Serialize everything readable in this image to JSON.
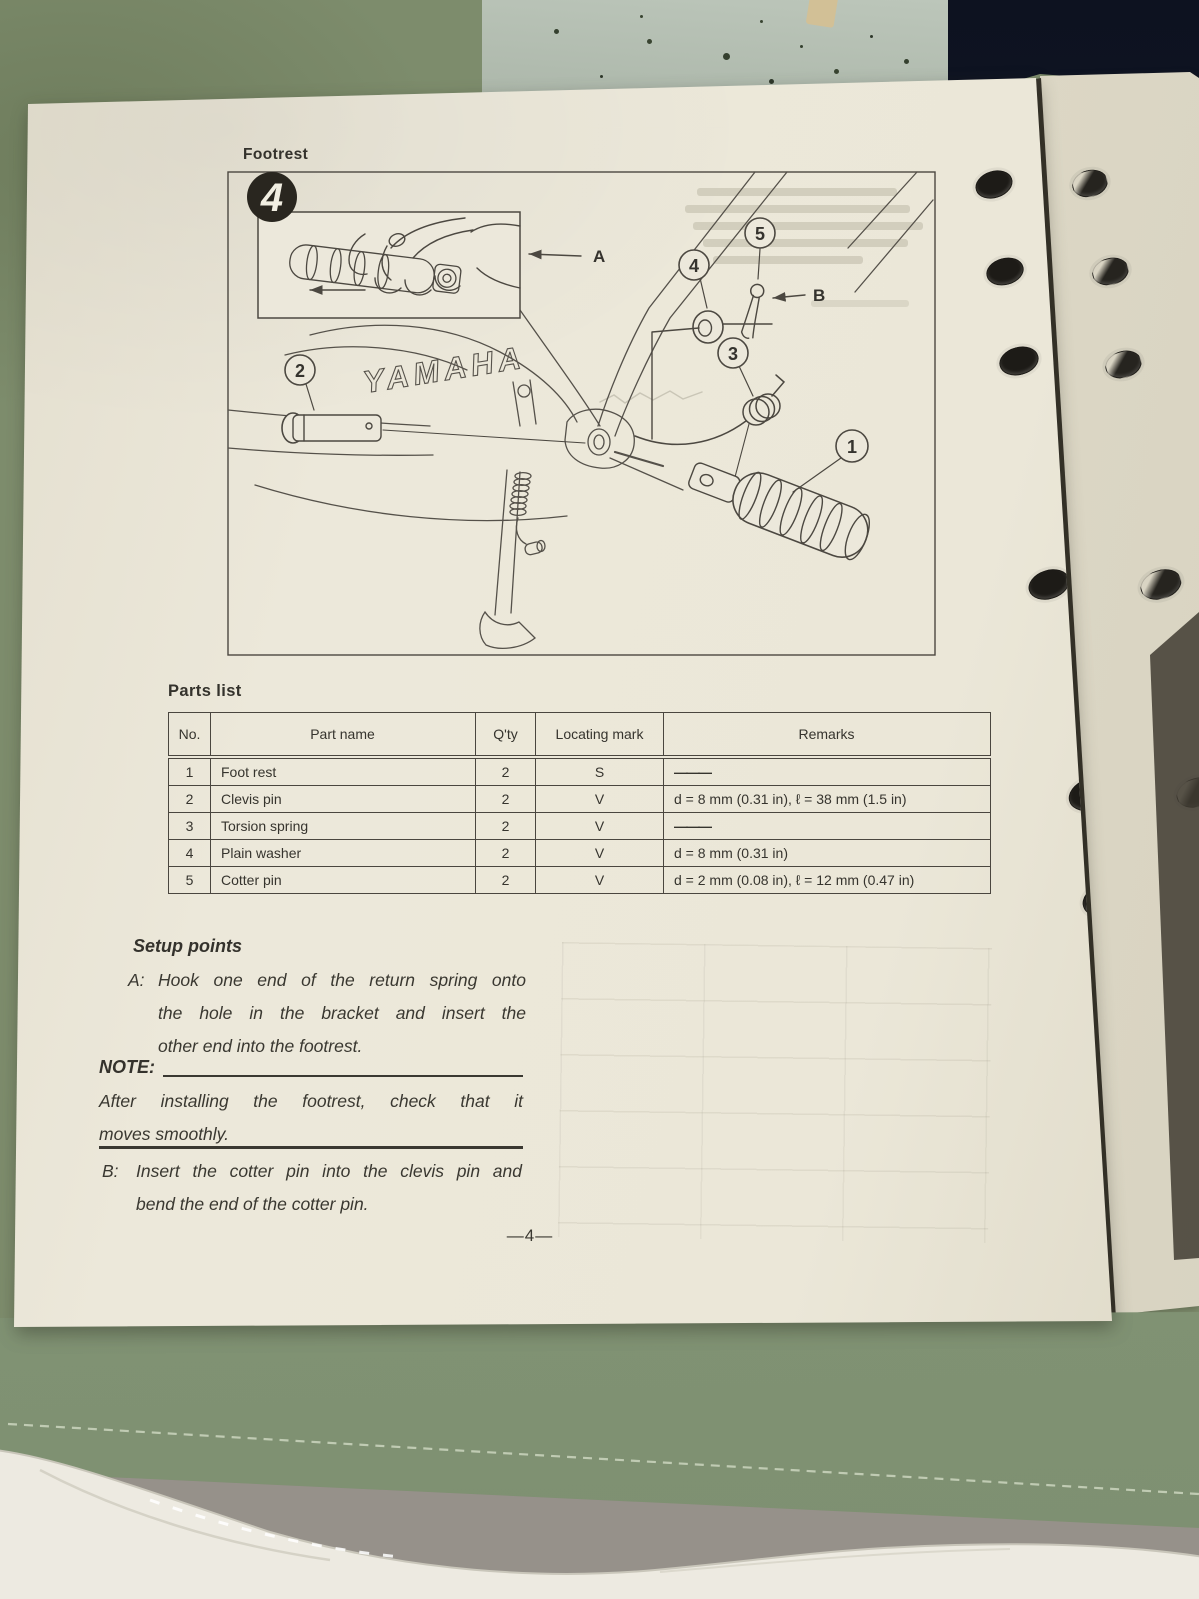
{
  "page": {
    "section_title": "Footrest",
    "page_number": "—4—",
    "diagram": {
      "badge": "4",
      "brand": "YAMAHA",
      "callouts": [
        "1",
        "2",
        "3",
        "4",
        "5"
      ],
      "labels": [
        "A",
        "B"
      ]
    },
    "parts_list": {
      "title": "Parts list",
      "columns": [
        "No.",
        "Part name",
        "Q'ty",
        "Locating mark",
        "Remarks"
      ],
      "rows": [
        {
          "no": "1",
          "name": "Foot rest",
          "qty": "2",
          "mark": "S",
          "remarks": "———"
        },
        {
          "no": "2",
          "name": "Clevis pin",
          "qty": "2",
          "mark": "V",
          "remarks": "d = 8 mm (0.31 in), ℓ = 38 mm (1.5 in)"
        },
        {
          "no": "3",
          "name": "Torsion spring",
          "qty": "2",
          "mark": "V",
          "remarks": "———"
        },
        {
          "no": "4",
          "name": "Plain washer",
          "qty": "2",
          "mark": "V",
          "remarks": "d = 8 mm (0.31 in)"
        },
        {
          "no": "5",
          "name": "Cotter pin",
          "qty": "2",
          "mark": "V",
          "remarks": "d = 2 mm (0.08 in), ℓ = 12 mm (0.47 in)"
        }
      ]
    },
    "setup": {
      "title": "Setup points",
      "point_a_label": "A:",
      "point_a_lines": [
        "Hook one end of the return spring onto",
        "the hole in the bracket and insert the",
        "other end into the footrest."
      ],
      "note_label": "NOTE:",
      "note_lines": [
        "After installing the footrest, check that it",
        "moves smoothly."
      ],
      "point_b_label": "B:",
      "point_b_lines": [
        "Insert the cotter pin into the clevis pin and",
        "bend the end of the cotter pin."
      ]
    }
  }
}
